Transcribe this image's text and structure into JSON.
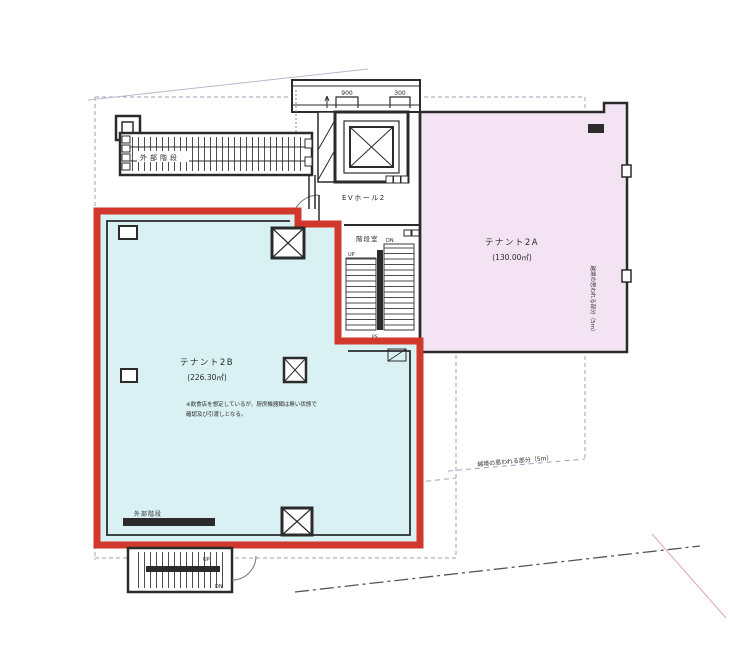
{
  "colors": {
    "highlight_red": "#d2372b",
    "tenant_b_fill": "#d9f1f3",
    "tenant_a_fill": "#f4e4f3",
    "wall": "#2b2b2b",
    "boundary_dash": "#9aa4b8"
  },
  "rooms": {
    "tenant_a": {
      "name": "テナント2A",
      "area": "(130.00㎡)"
    },
    "tenant_b": {
      "name": "テナント2B",
      "area": "(226.30㎡)",
      "note_line1": "※飲食店を想定しているが、厨房機器類は無い状態で",
      "note_line2": "確認及び引渡しとなる。"
    },
    "ev_hall": {
      "label": "EVホール2"
    },
    "stair_room": {
      "label": "階段室",
      "up": "UP",
      "dn": "DN"
    },
    "external_stair_top": {
      "label": "外部階段"
    },
    "external_stair_bottom": {
      "label": "外部階段",
      "up": "UP",
      "dn": "DN"
    }
  },
  "annotations": {
    "dim_left": "900",
    "dim_right": "300",
    "ps": "PS",
    "boundary_right_vertical": "越境の思われる部分（5m）",
    "boundary_bottom_diagonal": "越境の思われる部分（5m）"
  }
}
